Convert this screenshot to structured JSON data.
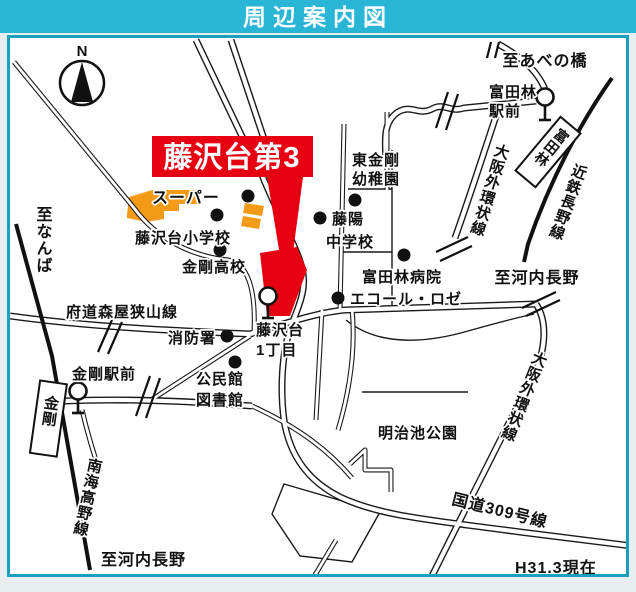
{
  "header": {
    "title": "周辺案内図"
  },
  "note": {
    "as_of": "H31.3現在"
  },
  "compass": {
    "north": "N"
  },
  "property": {
    "banner": "藤沢台第3"
  },
  "colors": {
    "header_bg": "#29b5d6",
    "frame": "#1b9fc0",
    "highlight_red": "#e60012",
    "area_orange": "#f39b19"
  },
  "destinations": {
    "abenobashi": "至あべの橋",
    "namba": "至なんば",
    "kawachinagano_east": "至河内長野",
    "kawachinagano_south": "至河内長野"
  },
  "railways": {
    "kintetsu_nagano": "近鉄長野線",
    "nankai_koya": "南海高野線"
  },
  "roads": {
    "osaka_outer_ring_upper": "大阪外環状線",
    "osaka_outer_ring_lower": "大阪外環状線",
    "fudo_moriya_sayama": "府道森屋狭山線",
    "route_309": "国道309号線"
  },
  "stations": {
    "tondabayashi_box": "富田林",
    "kongo_box": "金剛",
    "tondabayashi_ekimae": {
      "line1": "富田林",
      "line2": "駅前"
    },
    "kongo_ekimae": "金剛駅前"
  },
  "places": {
    "supermarket": "スーパー",
    "elementary_school": "藤沢台小学校",
    "high_school": "金剛高校",
    "kindergarten": {
      "line1": "東金剛",
      "line2": "幼稚園"
    },
    "junior_high": {
      "line1": "藤陽",
      "line2": "中学校"
    },
    "hospital": "富田林病院",
    "ecole_rose": "エコール・ロゼ",
    "fire_station": "消防署",
    "fujisawadai_1chome": {
      "line1": "藤沢台",
      "line2": "1丁目"
    },
    "community_center": {
      "line1": "公民館",
      "line2": "図書館"
    },
    "meijiike_park": "明治池公園"
  }
}
